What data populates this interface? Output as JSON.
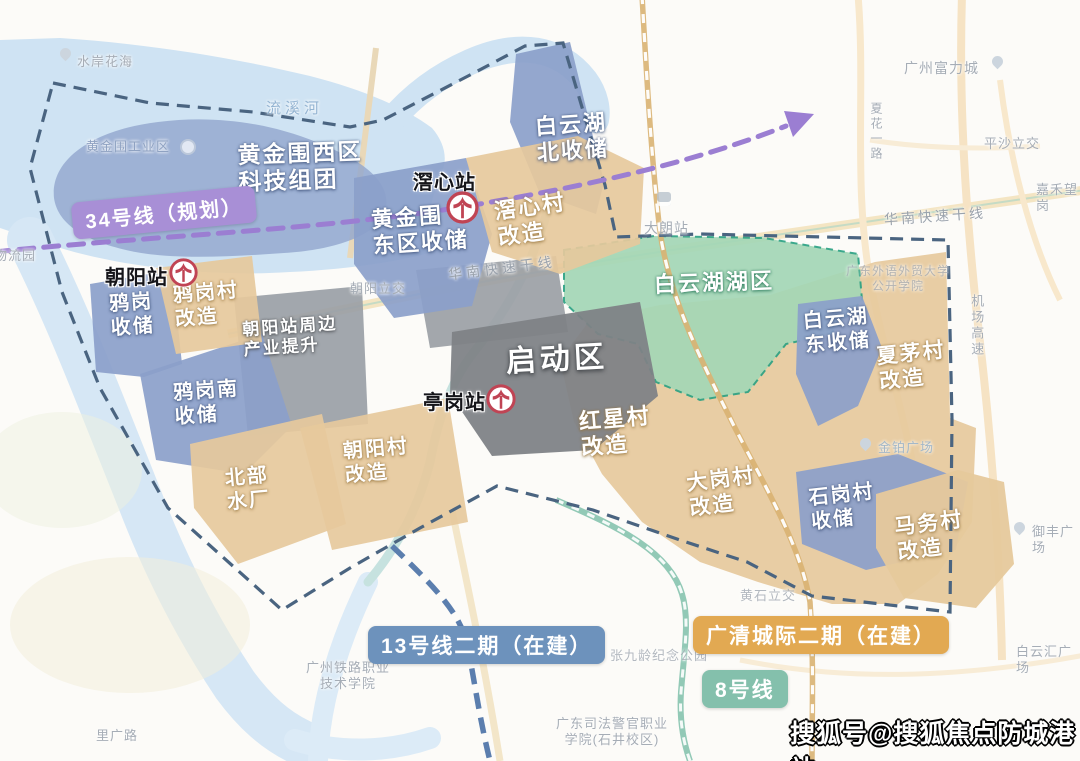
{
  "badges": {
    "line34": "34号线（规划）",
    "line13": "13号线二期（在建）",
    "gq_rail": "广清城际二期（在建）",
    "line8": "8号线"
  },
  "stations": {
    "jiaoxin": "滘心站",
    "chaoyang": "朝阳站",
    "tinggang": "亭岗站"
  },
  "zones": {
    "hjw_west": "黄金围西区\n科技组团",
    "byh_north": "白云湖\n北收储",
    "jiaoxin_village": "滘心村\n改造",
    "hjw_east": "黄金围\n东区收储",
    "yagang_village": "鸦岗村\n改造",
    "yagang_storage": "鸦岗\n收储",
    "uplift": "朝阳站周边\n产业提升",
    "yagang_south": "鸦岗南\n收储",
    "north_plant": "北部\n水厂",
    "chaoyang_village": "朝阳村\n改造",
    "qidong": "启动区",
    "lake": "白云湖湖区",
    "hongxing": "红星村\n改造",
    "byh_east": "白云湖\n东收储",
    "xiamao": "夏茅村\n改造",
    "dagang": "大岗村\n改造",
    "shigang": "石岗村\n收储",
    "mawu": "马务村\n改造"
  },
  "poi": {
    "shuian_huahai": "水岸花海",
    "liuxi_river": "流溪河",
    "hjw_industry": "黄金围工业区",
    "wuliuyuan": "物流园",
    "chaoyang_interchange": "朝阳立交",
    "hn_exp_1": "华南快速干线",
    "hn_exp_2": "华南快速干线",
    "gz_fuli": "广州富力城",
    "pingsha": "平沙立交",
    "jiahe": "嘉禾望岗",
    "xiahua_rd": "夏花一路",
    "dalang": "大朗站",
    "jichang_exp": "机场高速",
    "gdufs": "广东外语外贸大学\n公开学院",
    "jinbo": "金铂广场",
    "zhangjiuling": "张九龄纪念公园",
    "sifa": "广东司法警官职业\n学院(石井校区)",
    "tielu": "广州铁路职业\n技术学院",
    "liguang": "里广路",
    "huangshi": "黄石立交",
    "baiyunhui": "白云汇广场",
    "yufeng": "御丰广场"
  },
  "watermark": "搜狐号@搜狐焦点防城港站",
  "icons": {
    "metro_station": "guangzhou-metro-logo",
    "poi_pin": "map-pin",
    "railway_station": "railway-icon"
  },
  "colors": {
    "storage_blue": "#8b9fca",
    "renew_tan": "#e6c99c",
    "core_gray": "#7e8286",
    "lake_green": "#a4d7b6",
    "line34_purple": "#a88fd6",
    "line13_blue": "#6d92bc",
    "gq_orange": "#e2a952",
    "line8_teal": "#84c0ac",
    "boundary_navy": "#4a6480"
  }
}
